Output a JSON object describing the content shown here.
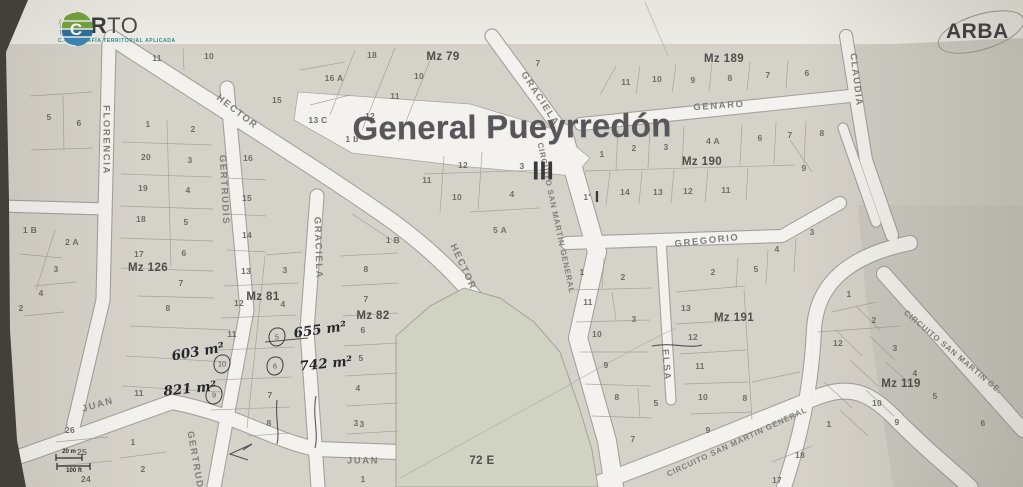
{
  "header": {
    "carto": {
      "brand_bold": "CAR",
      "brand_light": "TO",
      "subtitle": "CARTOGRAFÍA TERRITORIAL APLICADA"
    },
    "arba": {
      "brand": "ARBA"
    }
  },
  "map": {
    "title": "General Pueyrredón",
    "section_marks": [
      {
        "text": "III",
        "x": 543,
        "y": 171,
        "size": 26
      },
      {
        "text": "I",
        "x": 597,
        "y": 198,
        "size": 16
      }
    ],
    "block_labels": [
      {
        "text": "Mz 126",
        "x": 148,
        "y": 268
      },
      {
        "text": "Mz 81",
        "x": 263,
        "y": 297
      },
      {
        "text": "Mz 82",
        "x": 373,
        "y": 316
      },
      {
        "text": "Mz 79",
        "x": 443,
        "y": 57
      },
      {
        "text": "Mz 189",
        "x": 724,
        "y": 59
      },
      {
        "text": "Mz 190",
        "x": 702,
        "y": 162
      },
      {
        "text": "Mz 191",
        "x": 734,
        "y": 318
      },
      {
        "text": "Mz 119",
        "x": 901,
        "y": 384
      },
      {
        "text": "72 E",
        "x": 482,
        "y": 461
      }
    ],
    "street_labels": [
      {
        "text": "FLORENCIA",
        "x": 106,
        "y": 140,
        "rot": 90
      },
      {
        "text": "HECTOR",
        "x": 237,
        "y": 112,
        "rot": 38
      },
      {
        "text": "HECTOR",
        "x": 463,
        "y": 267,
        "rot": 65
      },
      {
        "text": "GERTRUDIS",
        "x": 224,
        "y": 190,
        "rot": 87
      },
      {
        "text": "GERTRUDIS",
        "x": 196,
        "y": 466,
        "rot": 80
      },
      {
        "text": "GRACIELA",
        "x": 318,
        "y": 248,
        "rot": 88
      },
      {
        "text": "GRACIELA",
        "x": 540,
        "y": 99,
        "rot": 57
      },
      {
        "text": "CIRCUITO SAN MARTIN GENERAL",
        "x": 556,
        "y": 218,
        "rot": 78,
        "size": 8,
        "ls": 0.8
      },
      {
        "text": "GENARO",
        "x": 719,
        "y": 106,
        "rot": -4
      },
      {
        "text": "GREGORIO",
        "x": 707,
        "y": 241,
        "rot": -6
      },
      {
        "text": "CLAUDIA",
        "x": 856,
        "y": 80,
        "rot": 83
      },
      {
        "text": "ELSA",
        "x": 666,
        "y": 365,
        "rot": 85
      },
      {
        "text": "JUAN",
        "x": 98,
        "y": 405,
        "rot": -16
      },
      {
        "text": "JUAN",
        "x": 363,
        "y": 461,
        "rot": 0
      },
      {
        "text": "CIRCUITO SAN MARTIN GENERAL",
        "x": 737,
        "y": 442,
        "rot": -25,
        "size": 8,
        "ls": 0.8
      },
      {
        "text": "CIRCUITO SAN MARTIN GE.",
        "x": 953,
        "y": 352,
        "rot": 40,
        "size": 8,
        "ls": 0.8
      }
    ],
    "parcel_labels": [
      {
        "text": "11",
        "x": 157,
        "y": 58
      },
      {
        "text": "10",
        "x": 209,
        "y": 56
      },
      {
        "text": "18",
        "x": 372,
        "y": 55
      },
      {
        "text": "10",
        "x": 419,
        "y": 76
      },
      {
        "text": "11",
        "x": 395,
        "y": 96
      },
      {
        "text": "12",
        "x": 370,
        "y": 116
      },
      {
        "text": "16 A",
        "x": 334,
        "y": 78
      },
      {
        "text": "15",
        "x": 277,
        "y": 100
      },
      {
        "text": "13 C",
        "x": 318,
        "y": 120
      },
      {
        "text": "1 b",
        "x": 352,
        "y": 139
      },
      {
        "text": "7",
        "x": 538,
        "y": 63
      },
      {
        "text": "5",
        "x": 49,
        "y": 117
      },
      {
        "text": "6",
        "x": 79,
        "y": 123
      },
      {
        "text": "1 B",
        "x": 30,
        "y": 230
      },
      {
        "text": "2 A",
        "x": 72,
        "y": 242
      },
      {
        "text": "3",
        "x": 56,
        "y": 269
      },
      {
        "text": "4",
        "x": 41,
        "y": 293
      },
      {
        "text": "2",
        "x": 21,
        "y": 308
      },
      {
        "text": "1",
        "x": 148,
        "y": 124
      },
      {
        "text": "2",
        "x": 193,
        "y": 129
      },
      {
        "text": "20",
        "x": 146,
        "y": 157
      },
      {
        "text": "3",
        "x": 190,
        "y": 160
      },
      {
        "text": "19",
        "x": 143,
        "y": 188
      },
      {
        "text": "4",
        "x": 188,
        "y": 190
      },
      {
        "text": "18",
        "x": 141,
        "y": 219
      },
      {
        "text": "5",
        "x": 186,
        "y": 222
      },
      {
        "text": "17",
        "x": 139,
        "y": 254
      },
      {
        "text": "6",
        "x": 184,
        "y": 253
      },
      {
        "text": "7",
        "x": 181,
        "y": 283
      },
      {
        "text": "8",
        "x": 168,
        "y": 308
      },
      {
        "text": "11",
        "x": 139,
        "y": 393
      },
      {
        "text": "16",
        "x": 248,
        "y": 158
      },
      {
        "text": "15",
        "x": 247,
        "y": 198
      },
      {
        "text": "14",
        "x": 247,
        "y": 235
      },
      {
        "text": "13",
        "x": 246,
        "y": 271
      },
      {
        "text": "12",
        "x": 239,
        "y": 303
      },
      {
        "text": "11",
        "x": 232,
        "y": 334
      },
      {
        "text": "3",
        "x": 285,
        "y": 270
      },
      {
        "text": "4",
        "x": 283,
        "y": 304
      },
      {
        "text": "7",
        "x": 270,
        "y": 395
      },
      {
        "text": "8",
        "x": 269,
        "y": 423
      },
      {
        "text": "1 B",
        "x": 393,
        "y": 240
      },
      {
        "text": "8",
        "x": 366,
        "y": 269
      },
      {
        "text": "7",
        "x": 366,
        "y": 299
      },
      {
        "text": "6",
        "x": 363,
        "y": 330
      },
      {
        "text": "5",
        "x": 361,
        "y": 358
      },
      {
        "text": "4",
        "x": 358,
        "y": 388
      },
      {
        "text": "3",
        "x": 356,
        "y": 423
      },
      {
        "text": "12",
        "x": 463,
        "y": 165
      },
      {
        "text": "11",
        "x": 427,
        "y": 180
      },
      {
        "text": "10",
        "x": 457,
        "y": 197
      },
      {
        "text": "3",
        "x": 522,
        "y": 166
      },
      {
        "text": "4",
        "x": 512,
        "y": 194
      },
      {
        "text": "5 A",
        "x": 500,
        "y": 230
      },
      {
        "text": "11",
        "x": 626,
        "y": 82
      },
      {
        "text": "10",
        "x": 657,
        "y": 79
      },
      {
        "text": "9",
        "x": 693,
        "y": 80
      },
      {
        "text": "8",
        "x": 730,
        "y": 78
      },
      {
        "text": "7",
        "x": 768,
        "y": 75
      },
      {
        "text": "6",
        "x": 807,
        "y": 73
      },
      {
        "text": "1",
        "x": 602,
        "y": 154
      },
      {
        "text": "2",
        "x": 634,
        "y": 148
      },
      {
        "text": "3",
        "x": 666,
        "y": 147
      },
      {
        "text": "4 A",
        "x": 713,
        "y": 141
      },
      {
        "text": "6",
        "x": 760,
        "y": 138
      },
      {
        "text": "7",
        "x": 790,
        "y": 135
      },
      {
        "text": "8",
        "x": 822,
        "y": 133
      },
      {
        "text": "1'",
        "x": 587,
        "y": 197
      },
      {
        "text": "14",
        "x": 625,
        "y": 192
      },
      {
        "text": "13",
        "x": 658,
        "y": 192
      },
      {
        "text": "12",
        "x": 688,
        "y": 191
      },
      {
        "text": "11",
        "x": 726,
        "y": 190
      },
      {
        "text": "9",
        "x": 804,
        "y": 168
      },
      {
        "text": "1",
        "x": 582,
        "y": 272
      },
      {
        "text": "2",
        "x": 623,
        "y": 277
      },
      {
        "text": "11",
        "x": 588,
        "y": 302
      },
      {
        "text": "3",
        "x": 634,
        "y": 319
      },
      {
        "text": "10",
        "x": 597,
        "y": 334
      },
      {
        "text": "9",
        "x": 606,
        "y": 365
      },
      {
        "text": "8",
        "x": 617,
        "y": 397
      },
      {
        "text": "5",
        "x": 656,
        "y": 403
      },
      {
        "text": "7",
        "x": 633,
        "y": 439
      },
      {
        "text": "2",
        "x": 713,
        "y": 272
      },
      {
        "text": "5",
        "x": 756,
        "y": 269
      },
      {
        "text": "4",
        "x": 777,
        "y": 249
      },
      {
        "text": "3",
        "x": 812,
        "y": 232
      },
      {
        "text": "13",
        "x": 686,
        "y": 308
      },
      {
        "text": "12",
        "x": 693,
        "y": 337
      },
      {
        "text": "11",
        "x": 700,
        "y": 366
      },
      {
        "text": "10",
        "x": 703,
        "y": 397
      },
      {
        "text": "9",
        "x": 708,
        "y": 430
      },
      {
        "text": "8",
        "x": 745,
        "y": 398
      },
      {
        "text": "1",
        "x": 849,
        "y": 294
      },
      {
        "text": "2",
        "x": 874,
        "y": 320
      },
      {
        "text": "12",
        "x": 838,
        "y": 343
      },
      {
        "text": "3",
        "x": 895,
        "y": 348
      },
      {
        "text": "4",
        "x": 915,
        "y": 373
      },
      {
        "text": "10",
        "x": 877,
        "y": 403
      },
      {
        "text": "5",
        "x": 935,
        "y": 396
      },
      {
        "text": "9",
        "x": 897,
        "y": 422
      },
      {
        "text": "6",
        "x": 983,
        "y": 423
      },
      {
        "text": "1",
        "x": 829,
        "y": 424
      },
      {
        "text": "18",
        "x": 800,
        "y": 455
      },
      {
        "text": "17",
        "x": 777,
        "y": 480
      },
      {
        "text": "26",
        "x": 70,
        "y": 430
      },
      {
        "text": "25",
        "x": 82,
        "y": 452
      },
      {
        "text": "24",
        "x": 86,
        "y": 479
      },
      {
        "text": "1",
        "x": 133,
        "y": 442
      },
      {
        "text": "2",
        "x": 143,
        "y": 469
      },
      {
        "text": "3",
        "x": 362,
        "y": 424
      },
      {
        "text": "1",
        "x": 363,
        "y": 479
      }
    ],
    "circled_parcels": [
      {
        "text": "5",
        "x": 277,
        "y": 337
      },
      {
        "text": "6",
        "x": 275,
        "y": 366
      },
      {
        "text": "10",
        "x": 222,
        "y": 364
      },
      {
        "text": "9",
        "x": 214,
        "y": 395
      }
    ],
    "annotations": [
      {
        "text": "603 m²",
        "x": 198,
        "y": 352,
        "rot": -10
      },
      {
        "text": "655 m²",
        "x": 320,
        "y": 330,
        "rot": -8
      },
      {
        "text": "742 m²",
        "x": 326,
        "y": 364,
        "rot": -6
      },
      {
        "text": "821 m²",
        "x": 190,
        "y": 389,
        "rot": -6
      }
    ],
    "scale_bar": {
      "top_label": "20 m",
      "bottom_label": "100 ft"
    },
    "colors": {
      "paper": "#efede7",
      "parcel_fill": "#d8d5cc",
      "street_fill": "#f7f6f1",
      "open_area_green": "#d2d6c2",
      "parcel_line": "#9c9b93",
      "title_text": "#55555a",
      "handwriting_ink": "#23232b",
      "carto_green": "#76a43d",
      "carto_blue": "#2f6f9c",
      "carto_teal": "#2e8f8a"
    }
  }
}
